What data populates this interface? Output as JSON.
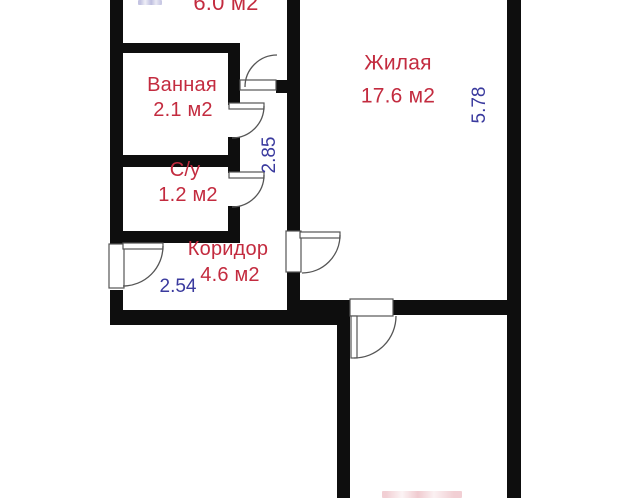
{
  "floorplan": {
    "units_suffix": "м2",
    "rooms": {
      "top": {
        "area": "6.0 м2"
      },
      "bathroom": {
        "name": "Ванная",
        "area": "2.1 м2"
      },
      "toilet": {
        "name": "С/у",
        "area": "1.2 м2"
      },
      "corridor": {
        "name": "Коридор",
        "area": "4.6 м2"
      },
      "living": {
        "name": "Жилая",
        "area": "17.6 м2"
      }
    },
    "dimensions": {
      "corridor_width": "2.54",
      "hall_height": "2.85",
      "living_height": "5.78"
    },
    "colors": {
      "room_label": "#c32b3f",
      "dimension_label": "#3a3a9e",
      "wall": "#0e0e0e",
      "door_line": "#555555",
      "background": "#ffffff"
    }
  }
}
